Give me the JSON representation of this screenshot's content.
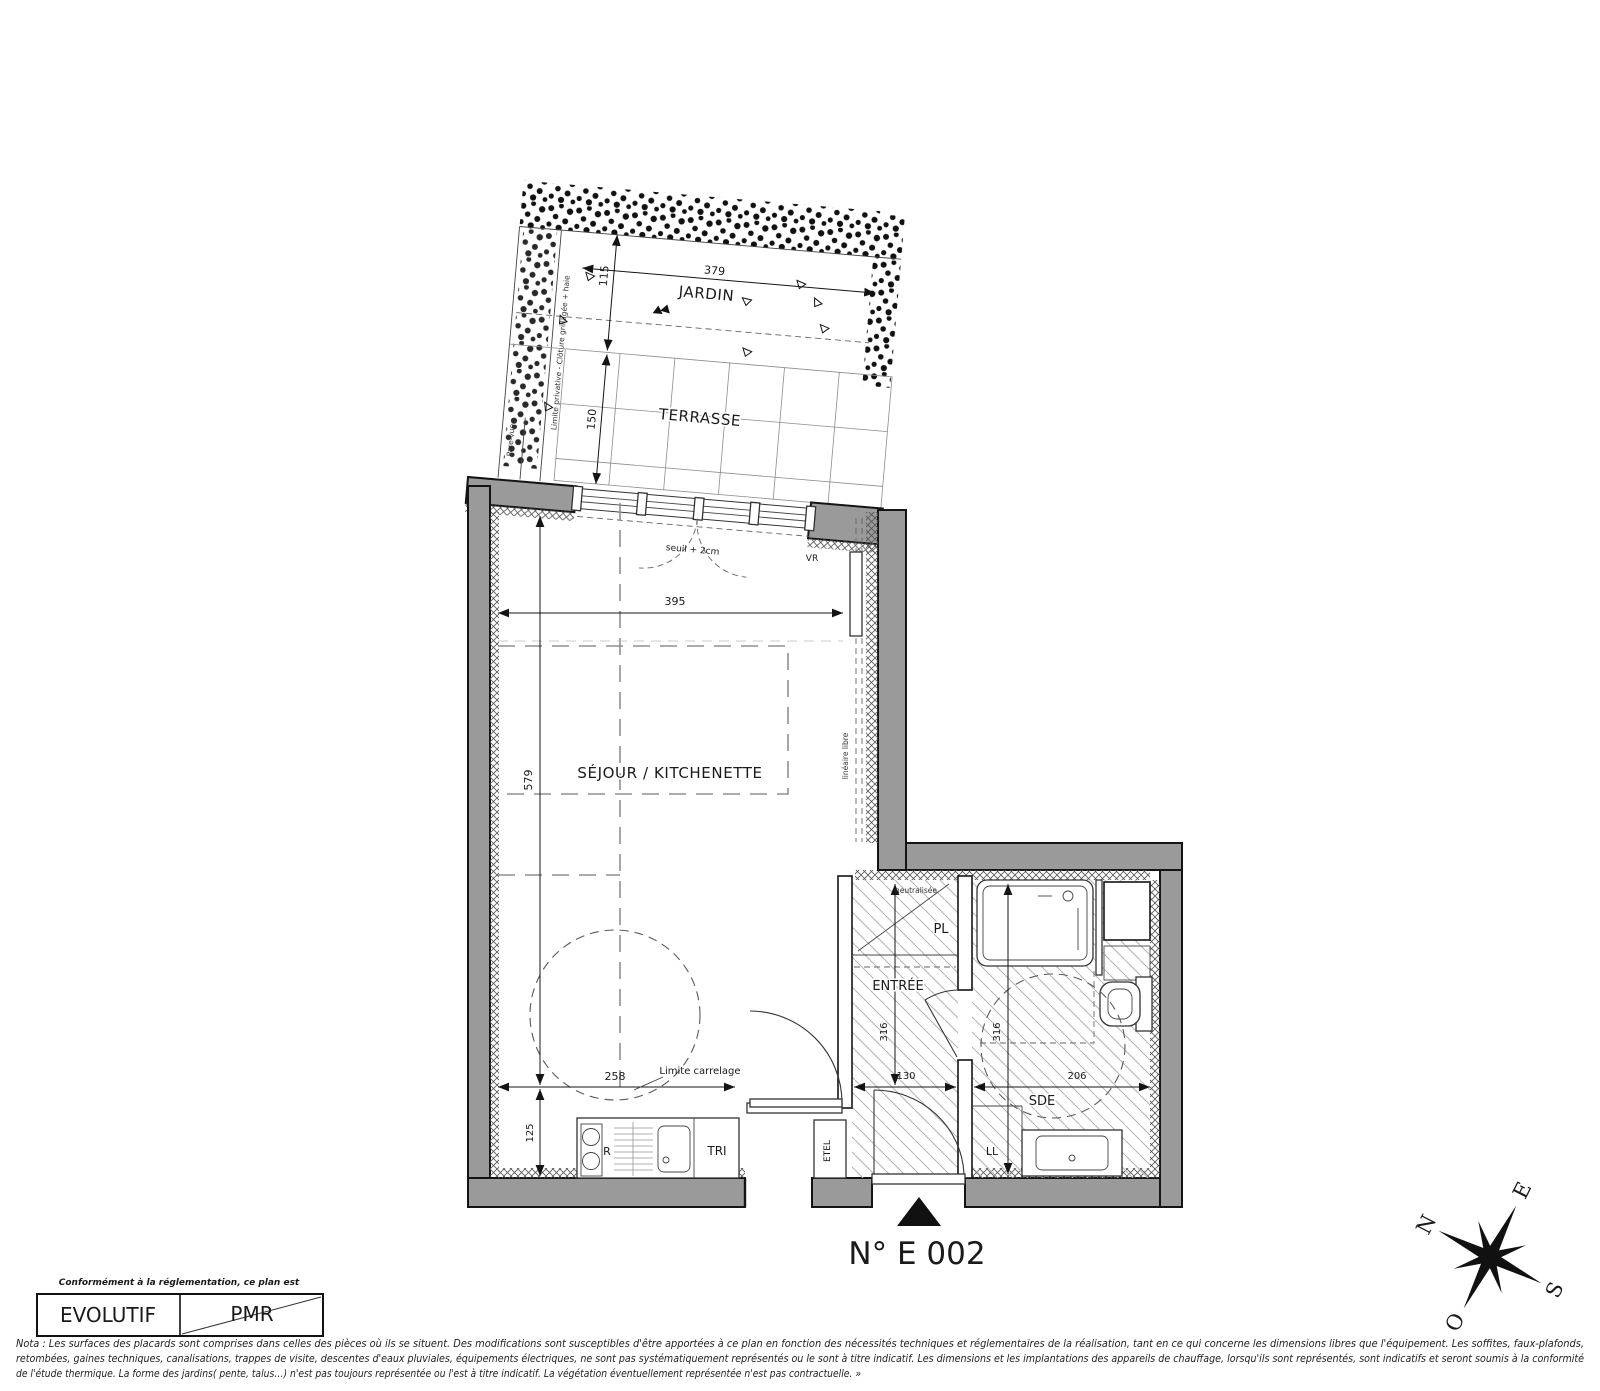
{
  "title": {
    "unit_number": "N° E 002"
  },
  "rooms": {
    "jardin": "JARDIN",
    "terrasse": "TERRASSE",
    "sejour": "SÉJOUR / KITCHENETTE",
    "entree": "ENTRÉE",
    "sde": "SDE",
    "pl": "PL"
  },
  "equipment": {
    "fridge": "R",
    "sorting": "TRI",
    "electrical": "ETEL",
    "washer": "LL",
    "shutter": "VR"
  },
  "annotations": {
    "seuil": "seuil + 2cm",
    "limite_carrelage": "Limite carrelage",
    "lineaire_libre": "linéaire libre",
    "limite_privative": "Limite privative - Clôture grillagée + haie",
    "pare_vue": "Pare-vue",
    "neutralisee": "neutralisée"
  },
  "dimensions": {
    "jardin_width": "379",
    "jardin_depth": "115",
    "terrasse_depth": "150",
    "sejour_width": "395",
    "sejour_depth": "579",
    "kitchen_width": "258",
    "kitchen_depth": "125",
    "entree_width": "130",
    "entree_depth": "316",
    "sde_width": "206",
    "sde_depth": "316"
  },
  "compass": {
    "north": "N",
    "east": "E",
    "south": "S",
    "west": "O"
  },
  "legend": {
    "caption": "Conformément à la réglementation, ce plan est",
    "evolutif": "EVOLUTIF",
    "pmr": "PMR"
  },
  "nota": {
    "line1": "Nota : Les surfaces des placards sont comprises dans celles des pièces où ils se situent. Des modifications sont susceptibles d'être apportées à ce plan en fonction des nécessités techniques et réglementaires de la réalisation, tant en ce qui concerne les dimensions libres que l'équipement.  Les soffites, faux-plafonds,",
    "line2": "retombées, gaines techniques, canalisations, trappes de visite, descentes d'eaux pluviales, équipements électriques, ne sont pas systématiquement représentés ou le sont à titre indicatif. Les dimensions et les implantations des appareils de chauffage, lorsqu'ils sont représentés, sont indicatifs et seront soumis à la conformité",
    "line3": "de l'étude thermique. La forme des jardins( pente, talus…) n'est pas toujours représentée ou l'est à titre indicatif. La végétation éventuellement représentée n'est pas contractuelle. »"
  }
}
